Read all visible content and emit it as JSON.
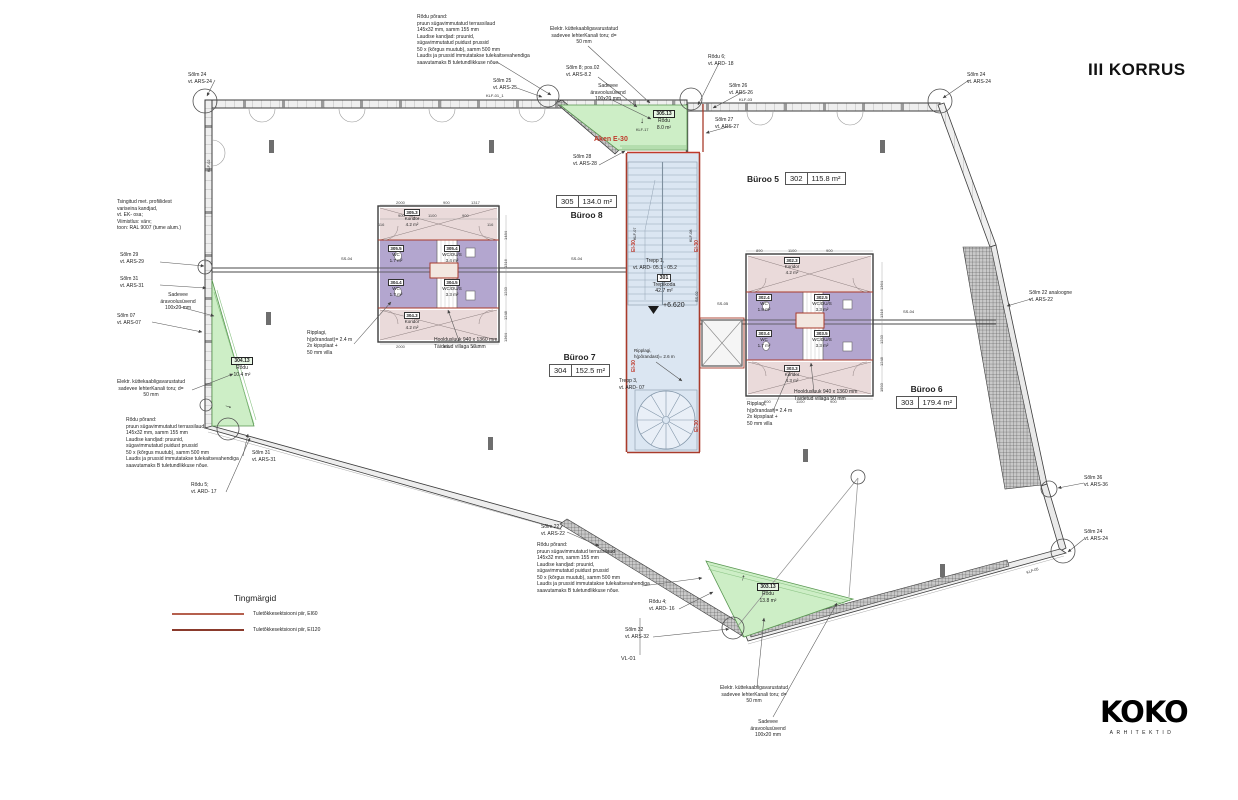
{
  "title": "III KORRUS",
  "logo": {
    "name": "KOKO",
    "sub": "ARHITEKTID"
  },
  "legend": {
    "title": "Tingmärgid",
    "items": [
      {
        "label": "Tuletõkkesektsiooni piir, EI60",
        "color": "#b5604e"
      },
      {
        "label": "Tuletõkkesektsiooni piir, EI120",
        "color": "#8a3a2c"
      }
    ]
  },
  "colors": {
    "balcony_green": "#cdeec6",
    "stair_blue": "#dbe6f2",
    "wc_purple": "#b3a6cf",
    "koridor_pink": "#eadada",
    "fire_red": "#a93b2b"
  },
  "room_tags": [
    {
      "name": "Büroo 8",
      "num": "305",
      "area": "134.0 m²",
      "x": 556,
      "y": 195,
      "cls": "box-first"
    },
    {
      "name": "Büroo 5",
      "num": "302",
      "area": "115.8 m²",
      "x": 747,
      "y": 172,
      "cls": "row"
    },
    {
      "name": "Büroo 7",
      "num": "304",
      "area": "152.5 m²",
      "x": 549,
      "y": 352
    },
    {
      "name": "Büroo 6",
      "num": "303",
      "area": "179.4 m²",
      "x": 896,
      "y": 384
    }
  ],
  "balcony_tags": [
    {
      "num": "305.13",
      "name": "Rõdu",
      "area": "8.0 m²",
      "x": 644,
      "y": 110
    },
    {
      "num": "304.13",
      "name": "Rõdu",
      "area": "10.4 m²",
      "x": 222,
      "y": 357
    },
    {
      "num": "303.13",
      "name": "Rõdu",
      "area": "13.8 m²",
      "x": 748,
      "y": 583
    }
  ],
  "core_labels": [
    {
      "num": "301",
      "name": "Trepikoda",
      "area": "42.7 m²",
      "x": 642,
      "y": 274,
      "fs": 5.2
    },
    {
      "num": "305.3",
      "name": "Koridor",
      "area": "4.2 m²",
      "x": 390,
      "y": 209
    },
    {
      "num": "305.5",
      "name": "WC",
      "area": "1.7 m²",
      "x": 374,
      "y": 245
    },
    {
      "num": "305.4",
      "name": "WC/DU/S",
      "area": "3.4 m²",
      "x": 430,
      "y": 245
    },
    {
      "num": "304.4",
      "name": "WC",
      "area": "1.7 m²",
      "x": 374,
      "y": 279
    },
    {
      "num": "304.5",
      "name": "WC/DU/S",
      "area": "3.3 m²",
      "x": 430,
      "y": 279
    },
    {
      "num": "304.3",
      "name": "Koridor",
      "area": "4.2 m²",
      "x": 390,
      "y": 312
    },
    {
      "num": "302.3",
      "name": "Koridor",
      "area": "4.2 m²",
      "x": 770,
      "y": 257
    },
    {
      "num": "302.4",
      "name": "WC",
      "area": "1.8 m²",
      "x": 742,
      "y": 294
    },
    {
      "num": "302.5",
      "name": "WC/DU/S",
      "area": "3.3 m²",
      "x": 800,
      "y": 294
    },
    {
      "num": "303.4",
      "name": "WC",
      "area": "1.7 m²",
      "x": 742,
      "y": 330
    },
    {
      "num": "303.5",
      "name": "WC/DU/S",
      "area": "3.3 m²",
      "x": 800,
      "y": 330
    },
    {
      "num": "303.3",
      "name": "Koridor",
      "area": "4.3 m²",
      "x": 770,
      "y": 365
    }
  ],
  "annotations": [
    {
      "t": "Sõlm 24\nvt. ARS-24",
      "x": 188,
      "y": 72
    },
    {
      "t": "Tsingitud met. profiilidest\nvariseina kandjad,\nvt. EK- osa;\nViimistlus: värv;\ntoon: RAL 9007 (tume alum.)",
      "x": 117,
      "y": 199,
      "w": 105
    },
    {
      "t": "Sõlm 29\nvt. ARS-29",
      "x": 120,
      "y": 252
    },
    {
      "t": "Sõlm 31\nvt. ARS-31",
      "x": 120,
      "y": 276
    },
    {
      "t": "Sadevee\näravoolusüvend\n100x20 mm",
      "x": 146,
      "y": 292,
      "w": 64,
      "al": "center"
    },
    {
      "t": "Sõlm 07\nvt. ARS-07",
      "x": 117,
      "y": 313
    },
    {
      "t": "Elektr. küttekaabligavarustatud\nsadevee lehterKanali toru; d=\n50 mm",
      "x": 95,
      "y": 379,
      "w": 112,
      "al": "center"
    },
    {
      "t": "Rõdu põrand:\npruun sügavimmutatud terrassilaud\n145x32 mm, samm 155 mm\nLaudise kandjad: pruunid,\nsügavimmutatud puidust prussid\n50 x (kõrgus muutub), samm 500 mm\nLaudis ja prussid immutatakse tulekaitsevahendiga\nsaavutamaks B tuletundlikkuse nõue.",
      "x": 126,
      "y": 417,
      "w": 152
    },
    {
      "t": "Sõlm 31\nvt. ARS-31",
      "x": 252,
      "y": 450
    },
    {
      "t": "Rõdu 5;\nvt. ARD- 17",
      "x": 191,
      "y": 482
    },
    {
      "t": "Rõdu põrand:\npruun sügavimmutatud terrassilaud\n145x32 mm, samm 155 mm\nLaudise kandjad: pruunid,\nsügavimmutatud puidust prussid\n50 x (kõrgus muutub), samm 500 mm\nLaudis ja prussid immutatakse tulekaitsevahendiga\nsaavutamaks B tuletundlikkuse nõue.",
      "x": 417,
      "y": 14,
      "w": 152
    },
    {
      "t": "Elektr. küttekaabligavarustatud\nsadevee lehterKanali toru; d=\n50 mm",
      "x": 528,
      "y": 26,
      "w": 112,
      "al": "center"
    },
    {
      "t": "Sõlm 25\nvt. ARS-25",
      "x": 493,
      "y": 78
    },
    {
      "t": "KLF-01_1",
      "x": 486,
      "y": 93,
      "fs": 4
    },
    {
      "t": "Sõlm 8; pos.02\nvt. ARS-8.2",
      "x": 566,
      "y": 65
    },
    {
      "t": "Sadevee\näravoolusüvend\n100x20 mm",
      "x": 576,
      "y": 83,
      "w": 64,
      "al": "center"
    },
    {
      "t": "Rõdu 6;\nvt. ARD- 18",
      "x": 708,
      "y": 54
    },
    {
      "t": "Sõlm 26\nvt. ARS-26",
      "x": 729,
      "y": 83
    },
    {
      "t": "KLF-03",
      "x": 739,
      "y": 97,
      "fs": 4
    },
    {
      "t": "Sõlm 27\nvt. ARS-27",
      "x": 715,
      "y": 117
    },
    {
      "t": "Sõlm 28\nvt. ARS-28",
      "x": 573,
      "y": 154
    },
    {
      "t": "Aken E-30",
      "x": 594,
      "y": 135,
      "fs": 7,
      "col": "#c0392b",
      "bold": 1
    },
    {
      "t": "Sõlm 24\nvt. ARS-24",
      "x": 967,
      "y": 72
    },
    {
      "t": "Sõlm 22 analoogne\nvt. ARS-22",
      "x": 1029,
      "y": 290
    },
    {
      "t": "Sõlm 36\nvt. ARS-36",
      "x": 1084,
      "y": 475
    },
    {
      "t": "Sõlm 24\nvt. ARS-24",
      "x": 1084,
      "y": 529
    },
    {
      "t": "Sõlm 22\nvt. ARS-22",
      "x": 541,
      "y": 524
    },
    {
      "t": "Rõdu põrand:\npruun sügavimmutatud terrassilaud\n145x32 mm, samm 155 mm\nLaudise kandjad: pruunid,\nsügavimmutatud puidust prussid\n50 x (kõrgus muutub), samm 500 mm\nLaudis ja prussid immutatakse tulekaitsevahendiga\nsaavutamaks B tuletundlikkuse nõue.",
      "x": 537,
      "y": 542,
      "w": 152
    },
    {
      "t": "Rõdu 4;\nvt. ARD- 16",
      "x": 649,
      "y": 599
    },
    {
      "t": "Sõlm 32\nvt. ARS-32",
      "x": 625,
      "y": 627
    },
    {
      "t": "VL-01",
      "x": 621,
      "y": 656,
      "fs": 5.5
    },
    {
      "t": "Elektr. küttekaabligavarustatud\nsadevee lehterKanali toru; d=\n50 mm",
      "x": 698,
      "y": 685,
      "w": 112,
      "al": "center"
    },
    {
      "t": "Sadevee\näravoolusüvend\n100x20 mm",
      "x": 736,
      "y": 719,
      "w": 64,
      "al": "center"
    },
    {
      "t": "Ripplagi,\nh(põrandast)= 2.4 m\n2x kipsplaat +\n50 mm villa",
      "x": 307,
      "y": 330
    },
    {
      "t": "Hooldusluuk 940 x 1360 mm\nTäidetud villaga 50 mm",
      "x": 434,
      "y": 337
    },
    {
      "t": "Trepp 1,\nvt. ARD- 05.1 - 05.2",
      "x": 622,
      "y": 258,
      "w": 66,
      "al": "center"
    },
    {
      "t": "+6.620",
      "x": 663,
      "y": 301,
      "fs": 7
    },
    {
      "t": "Ripplagi,\nh(põrandast)= 2.6 m",
      "x": 634,
      "y": 348,
      "fs": 4.5
    },
    {
      "t": "Trepp 3,\nvt. ARD- 07",
      "x": 619,
      "y": 378
    },
    {
      "t": "Ripplagi,\nh(põrandast)= 2.4 m\n2x kipsplaat +\n50 mm villa",
      "x": 747,
      "y": 401
    },
    {
      "t": "Hooldusluuk 940 x 1360 mm\nTäidetud villaga 50 mm",
      "x": 794,
      "y": 389
    },
    {
      "t": "SS-04",
      "x": 341,
      "y": 256,
      "fs": 4
    },
    {
      "t": "SS-04",
      "x": 571,
      "y": 256,
      "fs": 4
    },
    {
      "t": "SS-04",
      "x": 903,
      "y": 309,
      "fs": 4
    },
    {
      "t": "SS-05",
      "x": 717,
      "y": 301,
      "fs": 4
    },
    {
      "t": "EI-30",
      "x": 631,
      "y": 252,
      "rot": -90,
      "col": "#c0392b",
      "fs": 5,
      "bold": 1
    },
    {
      "t": "EI-30",
      "x": 694,
      "y": 252,
      "rot": -90,
      "col": "#c0392b",
      "fs": 5,
      "bold": 1
    },
    {
      "t": "EI-30",
      "x": 631,
      "y": 372,
      "rot": -90,
      "col": "#c0392b",
      "fs": 5,
      "bold": 1
    },
    {
      "t": "EI-30",
      "x": 694,
      "y": 432,
      "rot": -90,
      "col": "#c0392b",
      "fs": 5,
      "bold": 1
    },
    {
      "t": "KLF-07",
      "x": 633,
      "y": 240,
      "rot": -90,
      "fs": 3.8
    },
    {
      "t": "KLF-08",
      "x": 689,
      "y": 242,
      "rot": -90,
      "fs": 3.8
    },
    {
      "t": "SS-02",
      "x": 695,
      "y": 302,
      "rot": -90,
      "fs": 3.8
    },
    {
      "t": "KLF-17",
      "x": 636,
      "y": 128,
      "fs": 3.8
    },
    {
      "t": "↓",
      "x": 640,
      "y": 116,
      "fs": 8
    },
    {
      "t": "KLF-02",
      "x": 207,
      "y": 172,
      "rot": -90,
      "fs": 3.8
    },
    {
      "t": "KLF-05",
      "x": 1026,
      "y": 571,
      "rot": -18,
      "fs": 3.8
    },
    {
      "t": "→",
      "x": 226,
      "y": 399,
      "fs": 9,
      "rot": 18
    },
    {
      "t": "↑",
      "x": 742,
      "y": 572,
      "fs": 9,
      "rot": 12
    }
  ],
  "dims": [
    {
      "t": "2000",
      "x": 396,
      "y": 200
    },
    {
      "t": "900",
      "x": 443,
      "y": 200
    },
    {
      "t": "1317",
      "x": 471,
      "y": 200
    },
    {
      "t": "900",
      "x": 398,
      "y": 213
    },
    {
      "t": "1100",
      "x": 428,
      "y": 213
    },
    {
      "t": "900",
      "x": 462,
      "y": 213
    },
    {
      "t": "116",
      "x": 378,
      "y": 222
    },
    {
      "t": "116",
      "x": 487,
      "y": 222
    },
    {
      "t": "2000",
      "x": 396,
      "y": 344
    },
    {
      "t": "900",
      "x": 443,
      "y": 344
    },
    {
      "t": "1317",
      "x": 471,
      "y": 344
    },
    {
      "t": "1484",
      "x": 503,
      "y": 240,
      "rot": -90
    },
    {
      "t": "1316",
      "x": 503,
      "y": 268,
      "rot": -90
    },
    {
      "t": "1233",
      "x": 503,
      "y": 296,
      "rot": -90
    },
    {
      "t": "1248",
      "x": 503,
      "y": 320,
      "rot": -90
    },
    {
      "t": "1364",
      "x": 503,
      "y": 342,
      "rot": -90
    },
    {
      "t": "890",
      "x": 756,
      "y": 248
    },
    {
      "t": "1100",
      "x": 788,
      "y": 248
    },
    {
      "t": "900",
      "x": 826,
      "y": 248
    },
    {
      "t": "1364",
      "x": 879,
      "y": 290,
      "rot": -90
    },
    {
      "t": "1316",
      "x": 879,
      "y": 318,
      "rot": -90
    },
    {
      "t": "1233",
      "x": 879,
      "y": 344,
      "rot": -90
    },
    {
      "t": "1248",
      "x": 879,
      "y": 366,
      "rot": -90
    },
    {
      "t": "1593",
      "x": 879,
      "y": 392,
      "rot": -90
    },
    {
      "t": "900",
      "x": 764,
      "y": 399
    },
    {
      "t": "1100",
      "x": 796,
      "y": 399
    },
    {
      "t": "900",
      "x": 830,
      "y": 399
    }
  ]
}
